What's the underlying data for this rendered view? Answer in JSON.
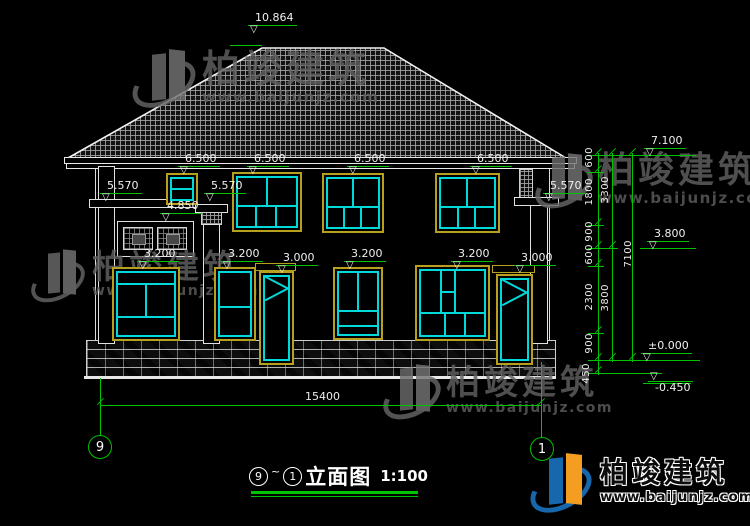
{
  "watermark": {
    "brand": "柏竣建筑",
    "site": "www.baijunjz.com"
  },
  "footer_logo": {
    "brand": "柏竣建筑",
    "site": "www.baijunjz.com"
  },
  "title": {
    "grid_start": "9",
    "separator": "~",
    "grid_end": "1",
    "name": "立面图",
    "scale": "1:100"
  },
  "grid_bubbles": {
    "left": "9",
    "right": "1"
  },
  "levels": {
    "ridge": "10.864",
    "f2_window_tops": [
      "6.500",
      "6.500",
      "6.500",
      "6.500"
    ],
    "porch_roofs": [
      "5.570",
      "5.570",
      "5.570"
    ],
    "railing_top": "4.850",
    "f1_window_tops": [
      "3.200",
      "3.200",
      "3.200",
      "3.200"
    ],
    "f1_door_tops": [
      "3.000",
      "3.000"
    ],
    "right_markers": {
      "eave": "7.100",
      "second_floor": "3.800",
      "ground": "±0.000",
      "site": "-0.450"
    }
  },
  "dimensions": {
    "right_segments": [
      "600",
      "1800",
      "900",
      "600",
      "2300",
      "900",
      "450"
    ],
    "right_subtotals": [
      "3300",
      "3800"
    ],
    "right_total": "7100",
    "bottom_width": "15400"
  },
  "icons": {
    "level_marker": "▽"
  }
}
